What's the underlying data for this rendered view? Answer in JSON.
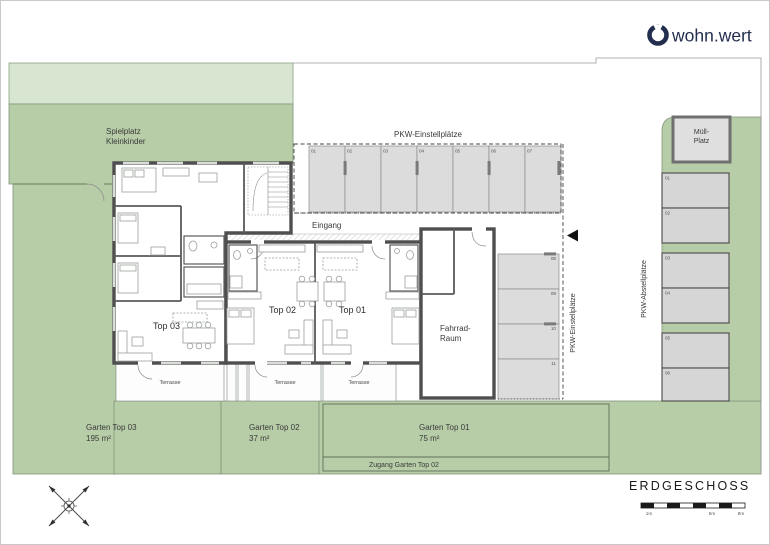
{
  "logo": {
    "name": "wohn.wert"
  },
  "site": {
    "spielplatz_line1": "Spielplatz",
    "spielplatz_line2": "Kleinkinder",
    "eingang": "Eingang",
    "terrasse": "Terrasse"
  },
  "building": {
    "top03": "Top 03",
    "top02": "Top 02",
    "top01": "Top 01",
    "fahrrad_line1": "Fahrrad-",
    "fahrrad_line2": "Raum"
  },
  "parking": {
    "einstellplaetze_top_label": "PKW-Einstellplätze",
    "top_stalls": [
      "01",
      "02",
      "03",
      "04",
      "05",
      "06",
      "07"
    ],
    "einstellplaetze_side_label": "PKW-Einstellplätze",
    "angled_stalls": [
      "08",
      "09",
      "10",
      "11"
    ],
    "abstellplaetze_label": "PKW-Abstellplätze",
    "right_stalls": [
      "01",
      "02",
      "03",
      "04",
      "05",
      "06"
    ],
    "muell_line1": "Müll-",
    "muell_line2": "Platz"
  },
  "gardens": {
    "top03_name": "Garten Top 03",
    "top03_area": "195 m²",
    "top02_name": "Garten Top 02",
    "top02_area": "37 m²",
    "top01_name": "Garten Top 01",
    "top01_area": "75 m²",
    "zugang": "Zugang Garten Top 02"
  },
  "footer": {
    "title": "ERDGESCHOSS",
    "scale_ticks": [
      "1m",
      "5m",
      "8m"
    ]
  },
  "colors": {
    "green_light": "#d8e5d1",
    "green": "#b7cda7",
    "wall_gray": "#4f4f4f",
    "stall_gray": "#dcdcdc",
    "logo_navy": "#232d4e"
  }
}
